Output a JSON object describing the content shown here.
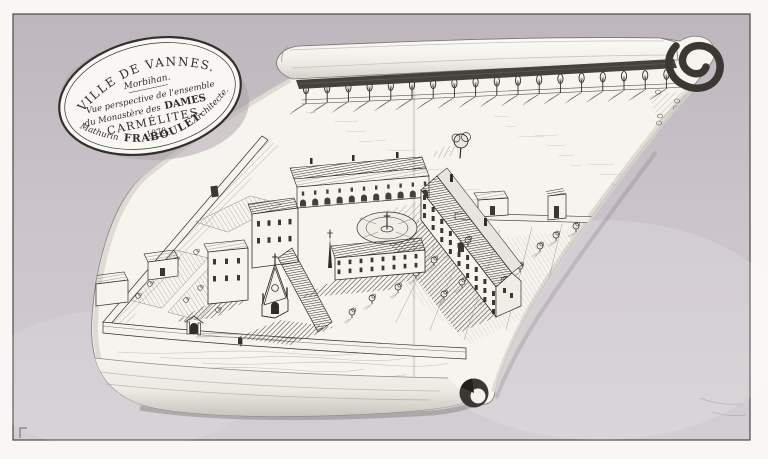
{
  "cartouche": {
    "city_line": "VILLE DE VANNES.",
    "region_line": "Morbihan.",
    "subtitle_line1": "Vue perspective de l'ensemble",
    "subtitle_line2a": "du Monastère des",
    "subtitle_line2b": "DAMES",
    "subtitle_line3": "CARMÉLITES.",
    "year": "1878.",
    "architect_first": "Mathurin",
    "architect_last": "FRABOULET",
    "architect_title": "Architecte."
  },
  "colors": {
    "photo_margin": "#f8f7f4",
    "photo_border": "#4b4845",
    "mat_background": "#c9c3c9",
    "parchment": "#f6f4ef",
    "ink": "#2f2d2a",
    "roll_shadow_band": "#45413c"
  }
}
